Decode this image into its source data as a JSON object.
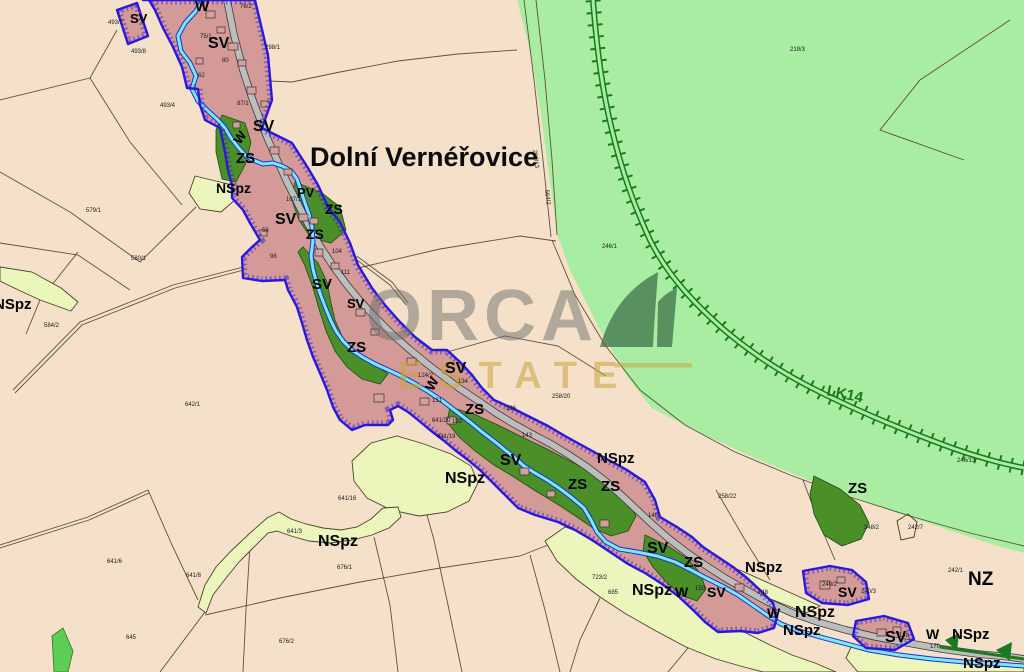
{
  "map": {
    "title": "Dolní Vernéřovice",
    "watermark": {
      "brand": "ORCA",
      "sub": "ESTATE"
    },
    "colors": {
      "background": "#f5e1c9",
      "forest": "#a9eda2",
      "village": "#d49a97",
      "garden_zs": "#4a8f28",
      "nspz": "#ecf5bb",
      "water": "#7de9ef",
      "road": "#bdbdbd",
      "boundary": "#2a18e0",
      "railway": "#1b7a1f",
      "watermark_text": "#6f6f6f",
      "watermark_gold": "#c9a43a"
    },
    "zone_labels": [
      {
        "t": "SV",
        "x": 130,
        "y": 23,
        "s": 13
      },
      {
        "t": "SV",
        "x": 208,
        "y": 48,
        "s": 16
      },
      {
        "t": "SV",
        "x": 253,
        "y": 131,
        "s": 16
      },
      {
        "t": "SV",
        "x": 275,
        "y": 224,
        "s": 16
      },
      {
        "t": "SV",
        "x": 312,
        "y": 289,
        "s": 15
      },
      {
        "t": "SV",
        "x": 347,
        "y": 308,
        "s": 13
      },
      {
        "t": "SV",
        "x": 445,
        "y": 373,
        "s": 16
      },
      {
        "t": "SV",
        "x": 500,
        "y": 465,
        "s": 16
      },
      {
        "t": "SV",
        "x": 647,
        "y": 553,
        "s": 16
      },
      {
        "t": "SV",
        "x": 707,
        "y": 597,
        "s": 14
      },
      {
        "t": "SV",
        "x": 838,
        "y": 597,
        "s": 14
      },
      {
        "t": "SV",
        "x": 885,
        "y": 642,
        "s": 16
      },
      {
        "t": "ZS",
        "x": 236,
        "y": 163,
        "s": 15
      },
      {
        "t": "ZS",
        "x": 325,
        "y": 214,
        "s": 14
      },
      {
        "t": "ZS",
        "x": 306,
        "y": 239,
        "s": 14
      },
      {
        "t": "ZS",
        "x": 347,
        "y": 352,
        "s": 15
      },
      {
        "t": "ZS",
        "x": 465,
        "y": 414,
        "s": 15
      },
      {
        "t": "ZS",
        "x": 568,
        "y": 489,
        "s": 15
      },
      {
        "t": "ZS",
        "x": 601,
        "y": 491,
        "s": 15
      },
      {
        "t": "ZS",
        "x": 684,
        "y": 567,
        "s": 15
      },
      {
        "t": "ZS",
        "x": 848,
        "y": 493,
        "s": 15
      },
      {
        "t": "NSpz",
        "x": 216,
        "y": 193,
        "s": 14
      },
      {
        "t": "NSpz",
        "x": -6,
        "y": 309,
        "s": 15
      },
      {
        "t": "NSpz",
        "x": 597,
        "y": 463,
        "s": 15
      },
      {
        "t": "NSpz",
        "x": 445,
        "y": 483,
        "s": 16
      },
      {
        "t": "NSpz",
        "x": 318,
        "y": 546,
        "s": 16
      },
      {
        "t": "NSpz",
        "x": 632,
        "y": 595,
        "s": 16
      },
      {
        "t": "NSpz",
        "x": 745,
        "y": 572,
        "s": 15
      },
      {
        "t": "NSpz",
        "x": 795,
        "y": 617,
        "s": 16
      },
      {
        "t": "NSpz",
        "x": 783,
        "y": 635,
        "s": 15
      },
      {
        "t": "NSpz",
        "x": 952,
        "y": 639,
        "s": 15
      },
      {
        "t": "NSpz",
        "x": 963,
        "y": 668,
        "s": 15
      },
      {
        "t": "W",
        "x": 195,
        "y": 11,
        "s": 15
      },
      {
        "t": "W",
        "x": 240,
        "y": 145,
        "s": 13,
        "r": -55
      },
      {
        "t": "W",
        "x": 433,
        "y": 392,
        "s": 14,
        "r": -62
      },
      {
        "t": "W",
        "x": 675,
        "y": 597,
        "s": 14
      },
      {
        "t": "W",
        "x": 767,
        "y": 618,
        "s": 14
      },
      {
        "t": "W",
        "x": 926,
        "y": 639,
        "s": 14
      },
      {
        "t": "PV",
        "x": 297,
        "y": 197,
        "s": 13
      },
      {
        "t": "NZ",
        "x": 968,
        "y": 585,
        "s": 19
      },
      {
        "t": "LK14",
        "x": 826,
        "y": 395,
        "s": 15,
        "c": "railway",
        "r": 12
      }
    ],
    "parcel_numbers": [
      {
        "t": "493/7",
        "x": 108,
        "y": 24
      },
      {
        "t": "493/8",
        "x": 131,
        "y": 53
      },
      {
        "t": "493/4",
        "x": 160,
        "y": 107
      },
      {
        "t": "579/1",
        "x": 86,
        "y": 212
      },
      {
        "t": "580/1",
        "x": 131,
        "y": 260
      },
      {
        "t": "584/2",
        "x": 44,
        "y": 327
      },
      {
        "t": "642/1",
        "x": 185,
        "y": 406
      },
      {
        "t": "645",
        "x": 126,
        "y": 639
      },
      {
        "t": "641/16",
        "x": 338,
        "y": 500
      },
      {
        "t": "641/3",
        "x": 287,
        "y": 533
      },
      {
        "t": "641/8",
        "x": 186,
        "y": 577
      },
      {
        "t": "641/6",
        "x": 107,
        "y": 563
      },
      {
        "t": "676/1",
        "x": 337,
        "y": 569
      },
      {
        "t": "676/2",
        "x": 279,
        "y": 643
      },
      {
        "t": "723/2",
        "x": 592,
        "y": 579
      },
      {
        "t": "685",
        "x": 608,
        "y": 594
      },
      {
        "t": "298/1",
        "x": 265,
        "y": 49
      },
      {
        "t": "246/1",
        "x": 602,
        "y": 248
      },
      {
        "t": "219/3",
        "x": 790,
        "y": 51
      },
      {
        "t": "246/13",
        "x": 957,
        "y": 462
      },
      {
        "t": "258/20",
        "x": 552,
        "y": 398
      },
      {
        "t": "258/22",
        "x": 718,
        "y": 498
      },
      {
        "t": "242/1",
        "x": 948,
        "y": 572
      },
      {
        "t": "242/7",
        "x": 908,
        "y": 529
      },
      {
        "t": "348/2",
        "x": 864,
        "y": 529
      },
      {
        "t": "107/1",
        "x": 286,
        "y": 201
      },
      {
        "t": "98",
        "x": 270,
        "y": 258
      },
      {
        "t": "58",
        "x": 262,
        "y": 232
      },
      {
        "t": "104",
        "x": 332,
        "y": 253
      },
      {
        "t": "111",
        "x": 341,
        "y": 274
      },
      {
        "t": "124/2",
        "x": 418,
        "y": 377
      },
      {
        "t": "131",
        "x": 432,
        "y": 402
      },
      {
        "t": "132",
        "x": 452,
        "y": 423
      },
      {
        "t": "134",
        "x": 458,
        "y": 383
      },
      {
        "t": "136",
        "x": 506,
        "y": 410
      },
      {
        "t": "641/20",
        "x": 432,
        "y": 422
      },
      {
        "t": "641/19",
        "x": 437,
        "y": 438
      },
      {
        "t": "143",
        "x": 522,
        "y": 437
      },
      {
        "t": "148",
        "x": 648,
        "y": 517
      },
      {
        "t": "75/1",
        "x": 200,
        "y": 38
      },
      {
        "t": "76/2",
        "x": 240,
        "y": 8
      },
      {
        "t": "80",
        "x": 222,
        "y": 62
      },
      {
        "t": "62",
        "x": 198,
        "y": 77
      },
      {
        "t": "87/1",
        "x": 237,
        "y": 105
      },
      {
        "t": "150",
        "x": 695,
        "y": 590
      },
      {
        "t": "148",
        "x": 758,
        "y": 594
      },
      {
        "t": "240/2",
        "x": 822,
        "y": 586
      },
      {
        "t": "240/3",
        "x": 861,
        "y": 593
      },
      {
        "t": "148",
        "x": 899,
        "y": 637
      },
      {
        "t": "170",
        "x": 930,
        "y": 648
      },
      {
        "t": "258/13",
        "x": 533,
        "y": 150,
        "r": 83
      },
      {
        "t": "564/2",
        "x": 545,
        "y": 190,
        "r": 83
      }
    ]
  }
}
